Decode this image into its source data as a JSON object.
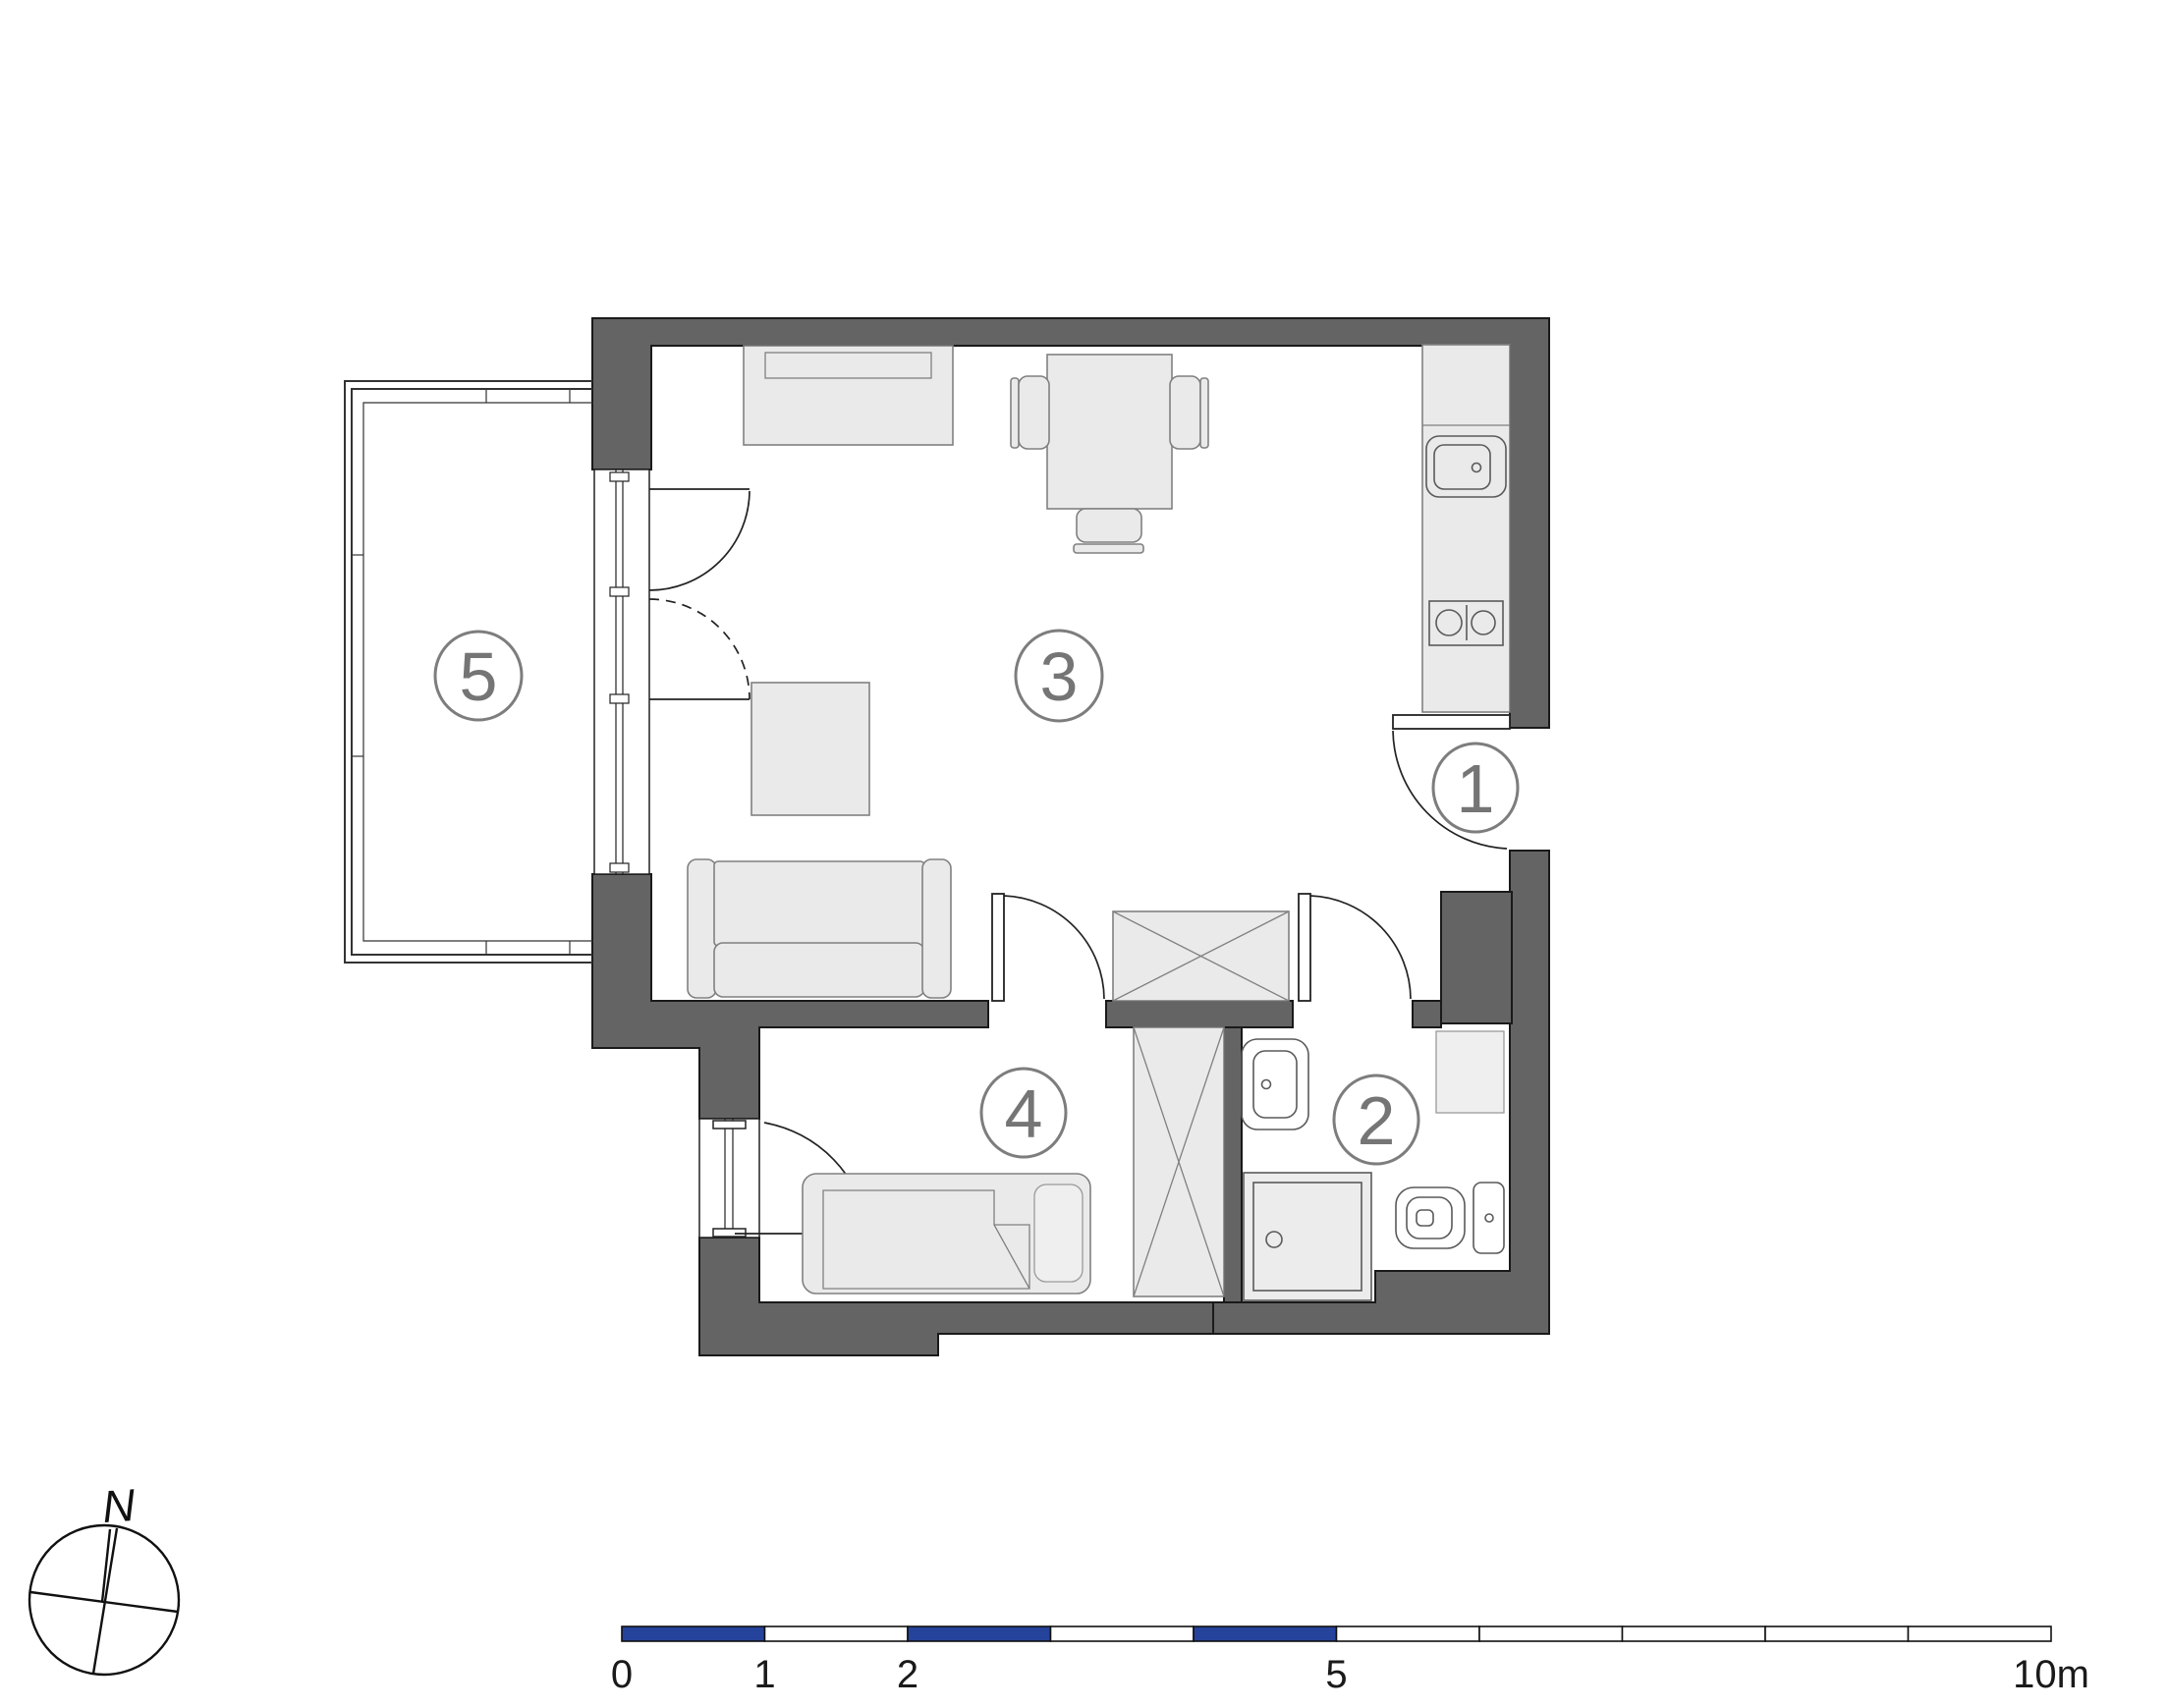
{
  "rooms": [
    {
      "number": "1"
    },
    {
      "number": "2"
    },
    {
      "number": "3"
    },
    {
      "number": "4"
    },
    {
      "number": "5"
    }
  ],
  "compass": {
    "north_label": "N"
  },
  "scale_bar": {
    "tick_labels": [
      "0",
      "1",
      "2",
      "5",
      "10m"
    ]
  },
  "colors": {
    "wall_fill": "#646464",
    "wall_outline": "#1a1a1a",
    "furniture_fill": "#eaeaea",
    "furniture_stroke": "#808080",
    "fixture_stroke": "#5a5a5a",
    "door_line": "#222222",
    "label_circle": "#7d7d7d",
    "label_text": "#757575",
    "scale_blue": "#25439b",
    "scale_outline": "#111111",
    "text_dark": "#1a1a1a",
    "balcony_line": "#333333",
    "page_bg": "#ffffff"
  }
}
